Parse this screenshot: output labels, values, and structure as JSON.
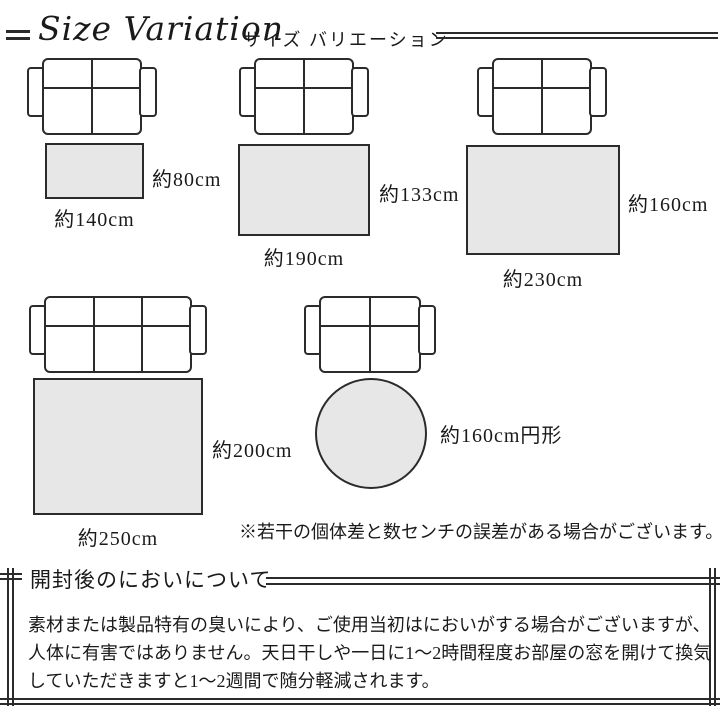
{
  "header": {
    "title": "Size Variation",
    "subtitle": "サイズ バリエーション"
  },
  "diagrams": [
    {
      "rug_shape": "rectangle",
      "sofa": "2-seat sofa",
      "width_label": "約140cm",
      "height_label": "約80cm"
    },
    {
      "rug_shape": "rectangle",
      "sofa": "2-seat sofa",
      "width_label": "約190cm",
      "height_label": "約133cm"
    },
    {
      "rug_shape": "rectangle",
      "sofa": "2-seat sofa",
      "width_label": "約230cm",
      "height_label": "約160cm"
    },
    {
      "rug_shape": "rectangle",
      "sofa": "3-seat sofa",
      "width_label": "約250cm",
      "height_label": "約200cm"
    },
    {
      "rug_shape": "circle",
      "sofa": "2-seat sofa",
      "size_label": "約160cm円形"
    }
  ],
  "disclaimer": "※若干の個体差と数センチの誤差がある場合がございます。",
  "odor_section": {
    "heading": "開封後のにおいについて",
    "body_lines": [
      "素材または製品特有の臭いにより、ご使用当初はにおいがする場合がございますが、",
      "人体に有害ではありません。天日干しや一日に1〜2時間程度お部屋の窓を開けて換気",
      "していただきますと1〜2週間で随分軽減されます。"
    ]
  },
  "colors": {
    "line": "#2b2b2b",
    "rug_fill": "#e7e7e7",
    "background": "#ffffff",
    "text": "#1a1a1a"
  }
}
